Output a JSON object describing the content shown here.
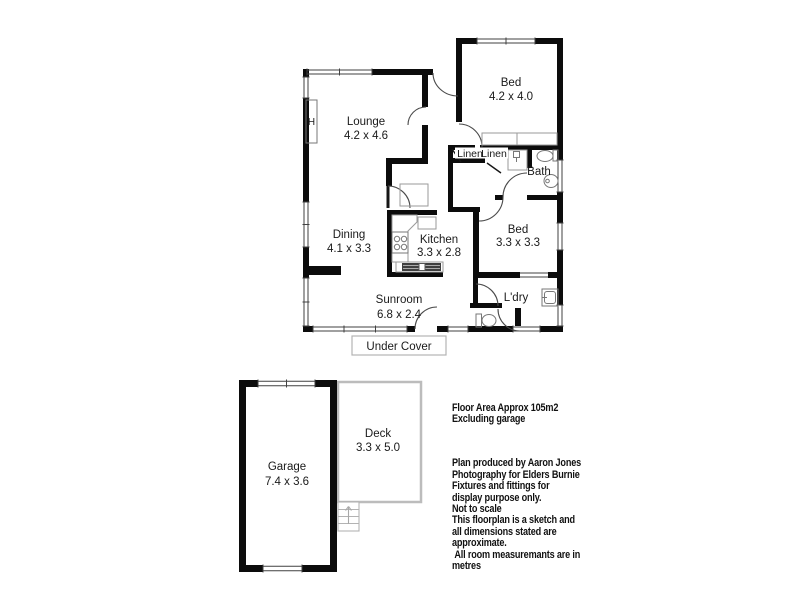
{
  "plan": {
    "title": "Residential floor plan sketch",
    "heater_label": "H",
    "rooms": [
      {
        "id": "lounge",
        "name": "Lounge",
        "dims": "4.2 x 4.6"
      },
      {
        "id": "bed-1",
        "name": "Bed",
        "dims": "4.2 x 4.0"
      },
      {
        "id": "bath",
        "name": "Bath",
        "dims": ""
      },
      {
        "id": "linen-1",
        "name": "Linen",
        "dims": ""
      },
      {
        "id": "linen-2",
        "name": "Linen",
        "dims": ""
      },
      {
        "id": "dining",
        "name": "Dining",
        "dims": "4.1 x 3.3"
      },
      {
        "id": "kitchen",
        "name": "Kitchen",
        "dims": "3.3 x 2.8"
      },
      {
        "id": "bed-2",
        "name": "Bed",
        "dims": "3.3 x 3.3"
      },
      {
        "id": "sunroom",
        "name": "Sunroom",
        "dims": "6.8 x 2.4"
      },
      {
        "id": "laundry",
        "name": "L'dry",
        "dims": ""
      },
      {
        "id": "under-cover",
        "name": "Under Cover",
        "dims": ""
      },
      {
        "id": "garage",
        "name": "Garage",
        "dims": "7.4 x 3.6"
      },
      {
        "id": "deck",
        "name": "Deck",
        "dims": "3.3 x 5.0"
      }
    ]
  },
  "notes": {
    "floor_area": "Floor Area Approx 105m2\nExcluding garage",
    "disclaimer": "Plan produced by Aaron Jones\nPhotography for Elders Burnie\nFixtures and fittings for\ndisplay purpose only.\nNot to scale\nThis floorplan is a sketch and\nall dimensions stated are\napproximate.\n All room measuremants are in\nmetres"
  },
  "colors": {
    "wall": "#0c0c0c",
    "window_line": "#414141",
    "door_arc": "#4a4a4a",
    "fixture": "#9a9a9a",
    "light_outline": "#b3b3b3",
    "text": "#1a1a1a"
  }
}
